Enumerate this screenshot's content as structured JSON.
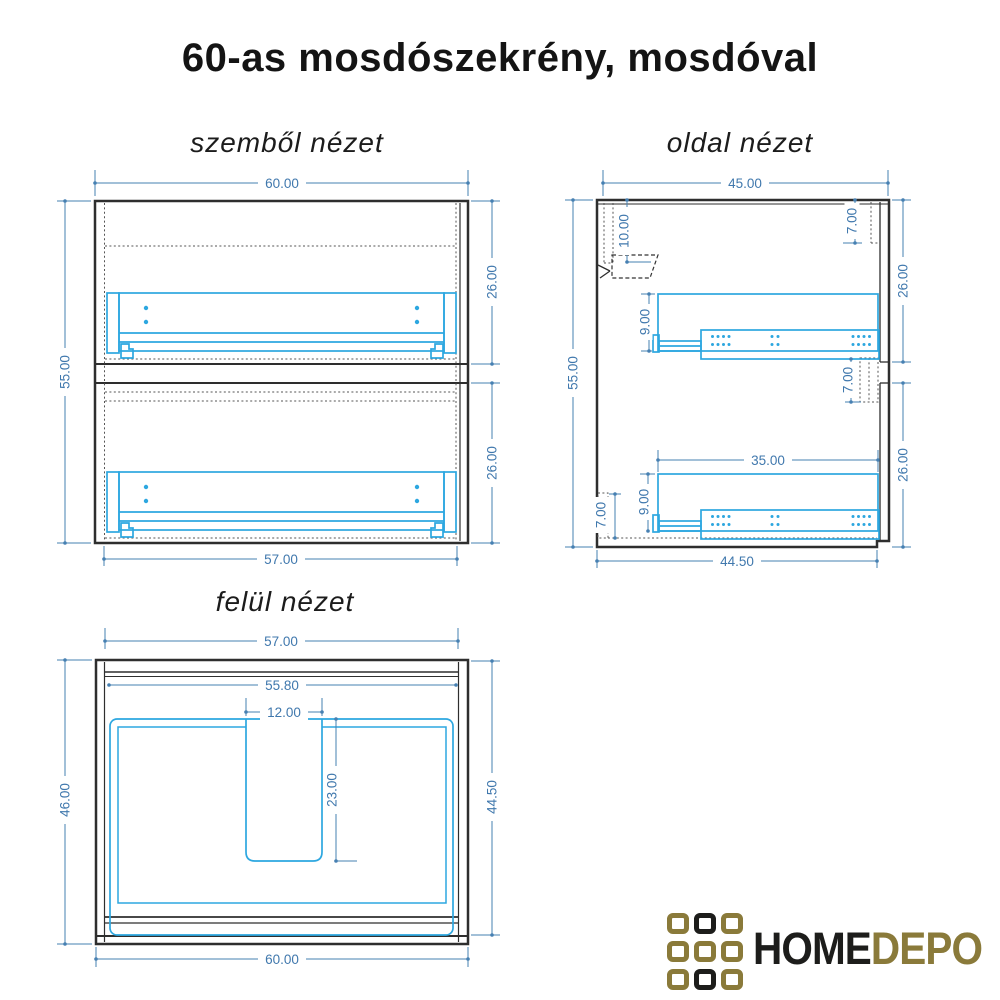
{
  "title": "60-as mosdószekrény, mosdóval",
  "views": {
    "front": {
      "label": "szemből nézet",
      "dims": {
        "width_top": "60.00",
        "height_left": "55.00",
        "upper_drawer_height": "26.00",
        "lower_drawer_height": "26.00",
        "width_bottom": "57.00"
      }
    },
    "side": {
      "label": "oldal nézet",
      "dims": {
        "depth_top": "45.00",
        "hanger_offset": "10.00",
        "top_right_inset": "7.00",
        "upper_section_height": "26.00",
        "upper_slide_height": "9.00",
        "mid_inset": "7.00",
        "height_left": "55.00",
        "slide_length": "35.00",
        "lower_slide_height": "9.00",
        "bottom_left_inset": "7.00",
        "lower_section_height": "26.00",
        "depth_bottom": "44.50"
      }
    },
    "top": {
      "label": "felül nézet",
      "dims": {
        "width_top": "57.00",
        "inner_width": "55.80",
        "cutout_width": "12.00",
        "cutout_depth": "23.00",
        "depth_left": "46.00",
        "depth_right": "44.50",
        "width_bottom": "60.00"
      }
    }
  },
  "logo": {
    "word_primary": "HOME",
    "word_secondary": "DEPO",
    "grid": [
      [
        "gold",
        "dark",
        "gold"
      ],
      [
        "gold",
        "gold",
        "gold"
      ],
      [
        "gold",
        "dark",
        "gold"
      ]
    ],
    "colors": {
      "gold": "#8a7a3a",
      "dark": "#1d1d1b"
    }
  },
  "colors": {
    "dimension_blue": "#4680b2",
    "drawer_blue": "#2da7e0",
    "line_black": "#2e2e2e"
  }
}
